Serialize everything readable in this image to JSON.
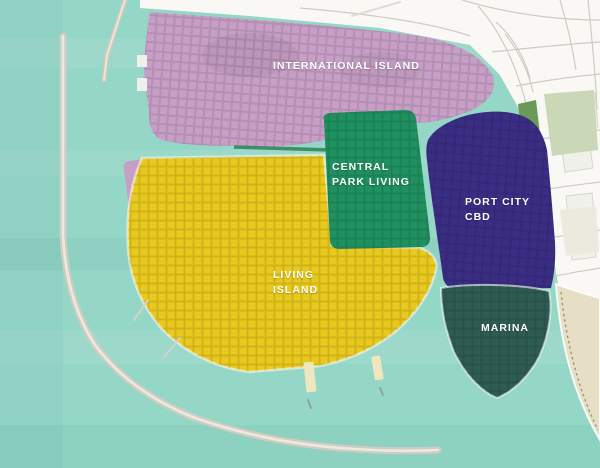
{
  "map": {
    "regions": [
      {
        "id": "international-island",
        "label_line1": "INTERNATIONAL ISLAND",
        "label_line2": "",
        "color": "#c79fc6",
        "text_color": "#ffffff"
      },
      {
        "id": "central-park-living",
        "label_line1": "CENTRAL",
        "label_line2": "PARK LIVING",
        "color": "#1f9160",
        "text_color": "#ffffff"
      },
      {
        "id": "port-city-cbd",
        "label_line1": "PORT CITY",
        "label_line2": "CBD",
        "color": "#3a2d84",
        "text_color": "#ffffff"
      },
      {
        "id": "living-island",
        "label_line1": "LIVING",
        "label_line2": "ISLAND",
        "color": "#e9c91d",
        "text_color": "#ffffff"
      },
      {
        "id": "marina",
        "label_line1": "MARINA",
        "label_line2": "",
        "color": "#2e5c52",
        "text_color": "#ffffff"
      }
    ],
    "palette": {
      "water": "#95d7c7",
      "mainland": "#f9f8f4",
      "breakwater": "#d0ccc2",
      "breakwater_highlight": "#ece9e1",
      "beach": "#e6dfc6",
      "railway": "#9b9070",
      "park_light": "#cbd8b8",
      "park_dark": "#6b9a58",
      "canal_green_strip": "#35865a",
      "pier": "#efe6bd"
    }
  }
}
